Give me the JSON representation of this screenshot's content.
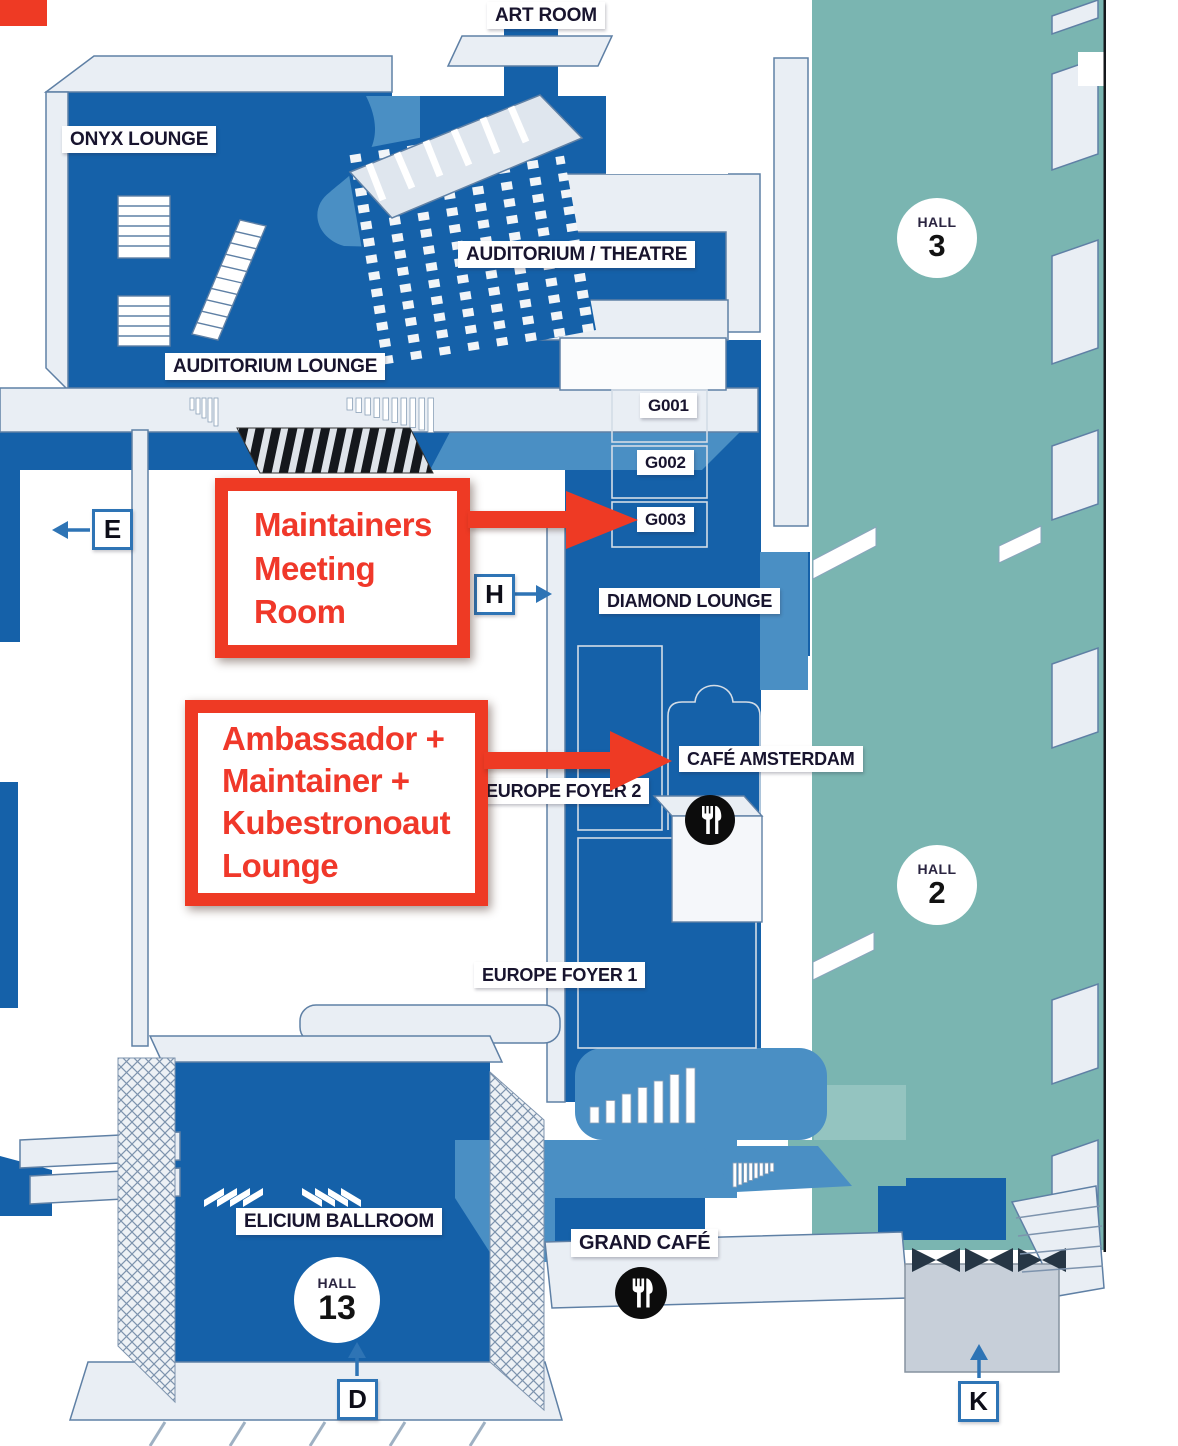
{
  "map": {
    "rooms": {
      "art_room": "ART ROOM",
      "onyx_lounge": "ONYX LOUNGE",
      "auditorium_theatre": "AUDITORIUM / THEATRE",
      "auditorium_lounge": "AUDITORIUM LOUNGE",
      "g001": "G001",
      "g002": "G002",
      "g003": "G003",
      "diamond_lounge": "DIAMOND LOUNGE",
      "cafe_amsterdam": "CAFÉ AMSTERDAM",
      "europe_foyer_2": "EUROPE FOYER 2",
      "europe_foyer_1": "EUROPE FOYER 1",
      "elicium_ballroom": "ELICIUM BALLROOM",
      "grand_cafe": "GRAND CAFÉ"
    },
    "halls": {
      "label": "HALL",
      "hall_3": "3",
      "hall_2": "2",
      "hall_13": "13"
    },
    "entrances": {
      "e": "E",
      "h": "H",
      "d": "D",
      "k": "K"
    },
    "icons": {
      "cafe_amsterdam": "utensils-icon",
      "grand_cafe": "utensils-icon"
    }
  },
  "annotations": {
    "maintainers_meeting_room": {
      "line_1": "Maintainers",
      "line_2": "Meeting",
      "line_3": "Room",
      "points_to": "G003"
    },
    "ambassador_lounge": {
      "line_1": "Ambassador +",
      "line_2": "Maintainer +",
      "line_3": "Kubestronoaut",
      "line_4": "Lounge",
      "points_to": "CAFÉ AMSTERDAM"
    }
  },
  "colors": {
    "dark_blue": "#1561a9",
    "mid_blue": "#4a8fc4",
    "teal": "#7ab5b1",
    "annotation_red": "#ee3a24",
    "wall_fill": "#e9eef4",
    "wall_stroke": "#5f80a5"
  }
}
